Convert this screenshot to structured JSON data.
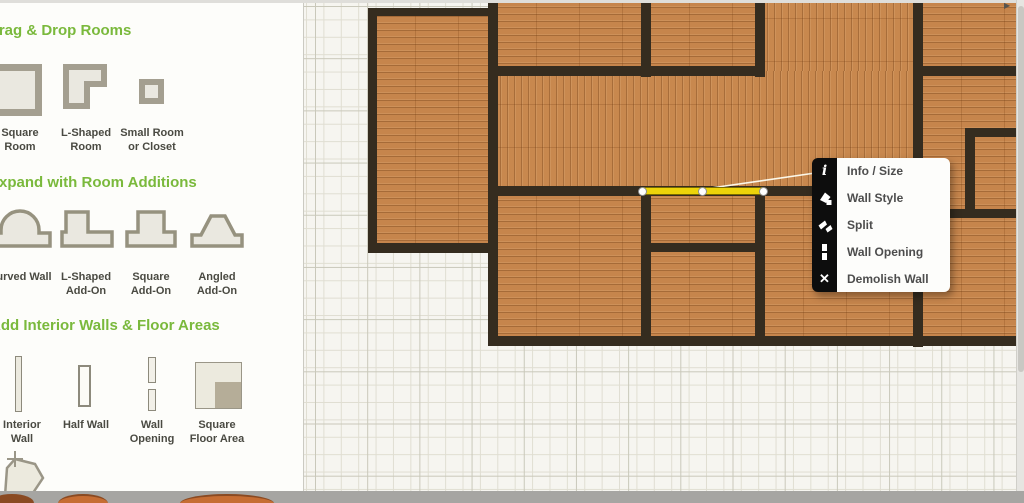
{
  "sidebar": {
    "sections": [
      {
        "title": "Drag & Drop Rooms",
        "items": [
          {
            "label": "Square Room"
          },
          {
            "label": "L-Shaped Room"
          },
          {
            "label": "Small Room or Closet"
          }
        ]
      },
      {
        "title": "Expand with Room Additions",
        "items": [
          {
            "label": "Curved Wall"
          },
          {
            "label": "L-Shaped Add-On"
          },
          {
            "label": "Square Add-On"
          },
          {
            "label": "Angled Add-On"
          }
        ]
      },
      {
        "title": "Add Interior Walls & Floor Areas",
        "items": [
          {
            "label": "Interior Wall"
          },
          {
            "label": "Half Wall"
          },
          {
            "label": "Wall Opening"
          },
          {
            "label": "Square Floor Area"
          }
        ]
      }
    ]
  },
  "context_menu": {
    "items": [
      {
        "name": "info-size",
        "label": "Info / Size",
        "glyph": "i"
      },
      {
        "name": "wall-style",
        "label": "Wall Style",
        "glyph": ""
      },
      {
        "name": "split",
        "label": "Split",
        "glyph": ""
      },
      {
        "name": "wall-opening",
        "label": "Wall Opening",
        "glyph": ""
      },
      {
        "name": "demolish-wall",
        "label": "Demolish Wall",
        "glyph": "✕"
      }
    ]
  },
  "colors": {
    "accent_green": "#7ab93c",
    "selected_wall_yellow": "#ecd40a",
    "wall_dark": "#352c1f",
    "wood": "#c6854c"
  }
}
